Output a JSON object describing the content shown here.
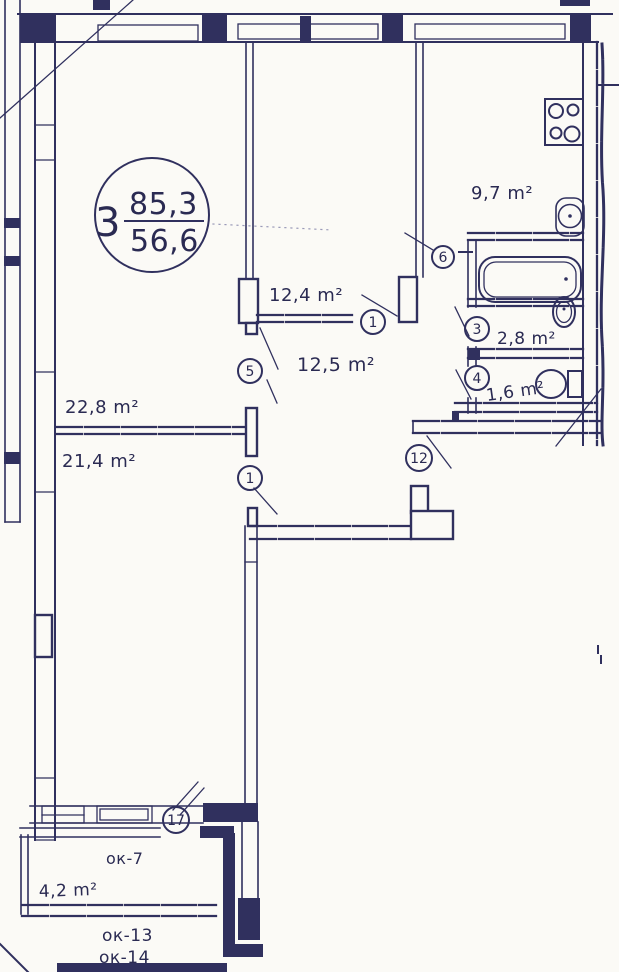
{
  "stamp": {
    "apartment_number": "3",
    "total_area": "85,3",
    "living_area": "56,6"
  },
  "rooms": {
    "kitchen": {
      "area": "9,7 m²"
    },
    "bedroom": {
      "area": "12,4 m²"
    },
    "hall": {
      "area": "12,5 m²"
    },
    "bathroom": {
      "area": "2,8 m²"
    },
    "wc": {
      "area": "1,6 m²"
    },
    "living_room": {
      "area": "22,8 m²"
    },
    "bedroom2": {
      "area": "21,4 m²"
    },
    "balcony": {
      "area": "4,2 m²"
    }
  },
  "markers": [
    {
      "label": "1"
    },
    {
      "label": "6"
    },
    {
      "label": "3"
    },
    {
      "label": "4"
    },
    {
      "label": "5"
    },
    {
      "label": "1"
    },
    {
      "label": "12"
    },
    {
      "label": "17"
    }
  ],
  "windows": {
    "ok7": "ок-7",
    "ok13": "ок-13",
    "ok14": "ок-14"
  },
  "fixtures": {
    "stove": "stove-4-burner-icon",
    "kitchen_sink": "kitchen-sink-icon",
    "bathtub": "bathtub-icon",
    "wash_basin": "wash-basin-icon",
    "toilet": "toilet-icon"
  },
  "colors": {
    "ink": "#30305e",
    "paper": "#fbfaf6"
  }
}
